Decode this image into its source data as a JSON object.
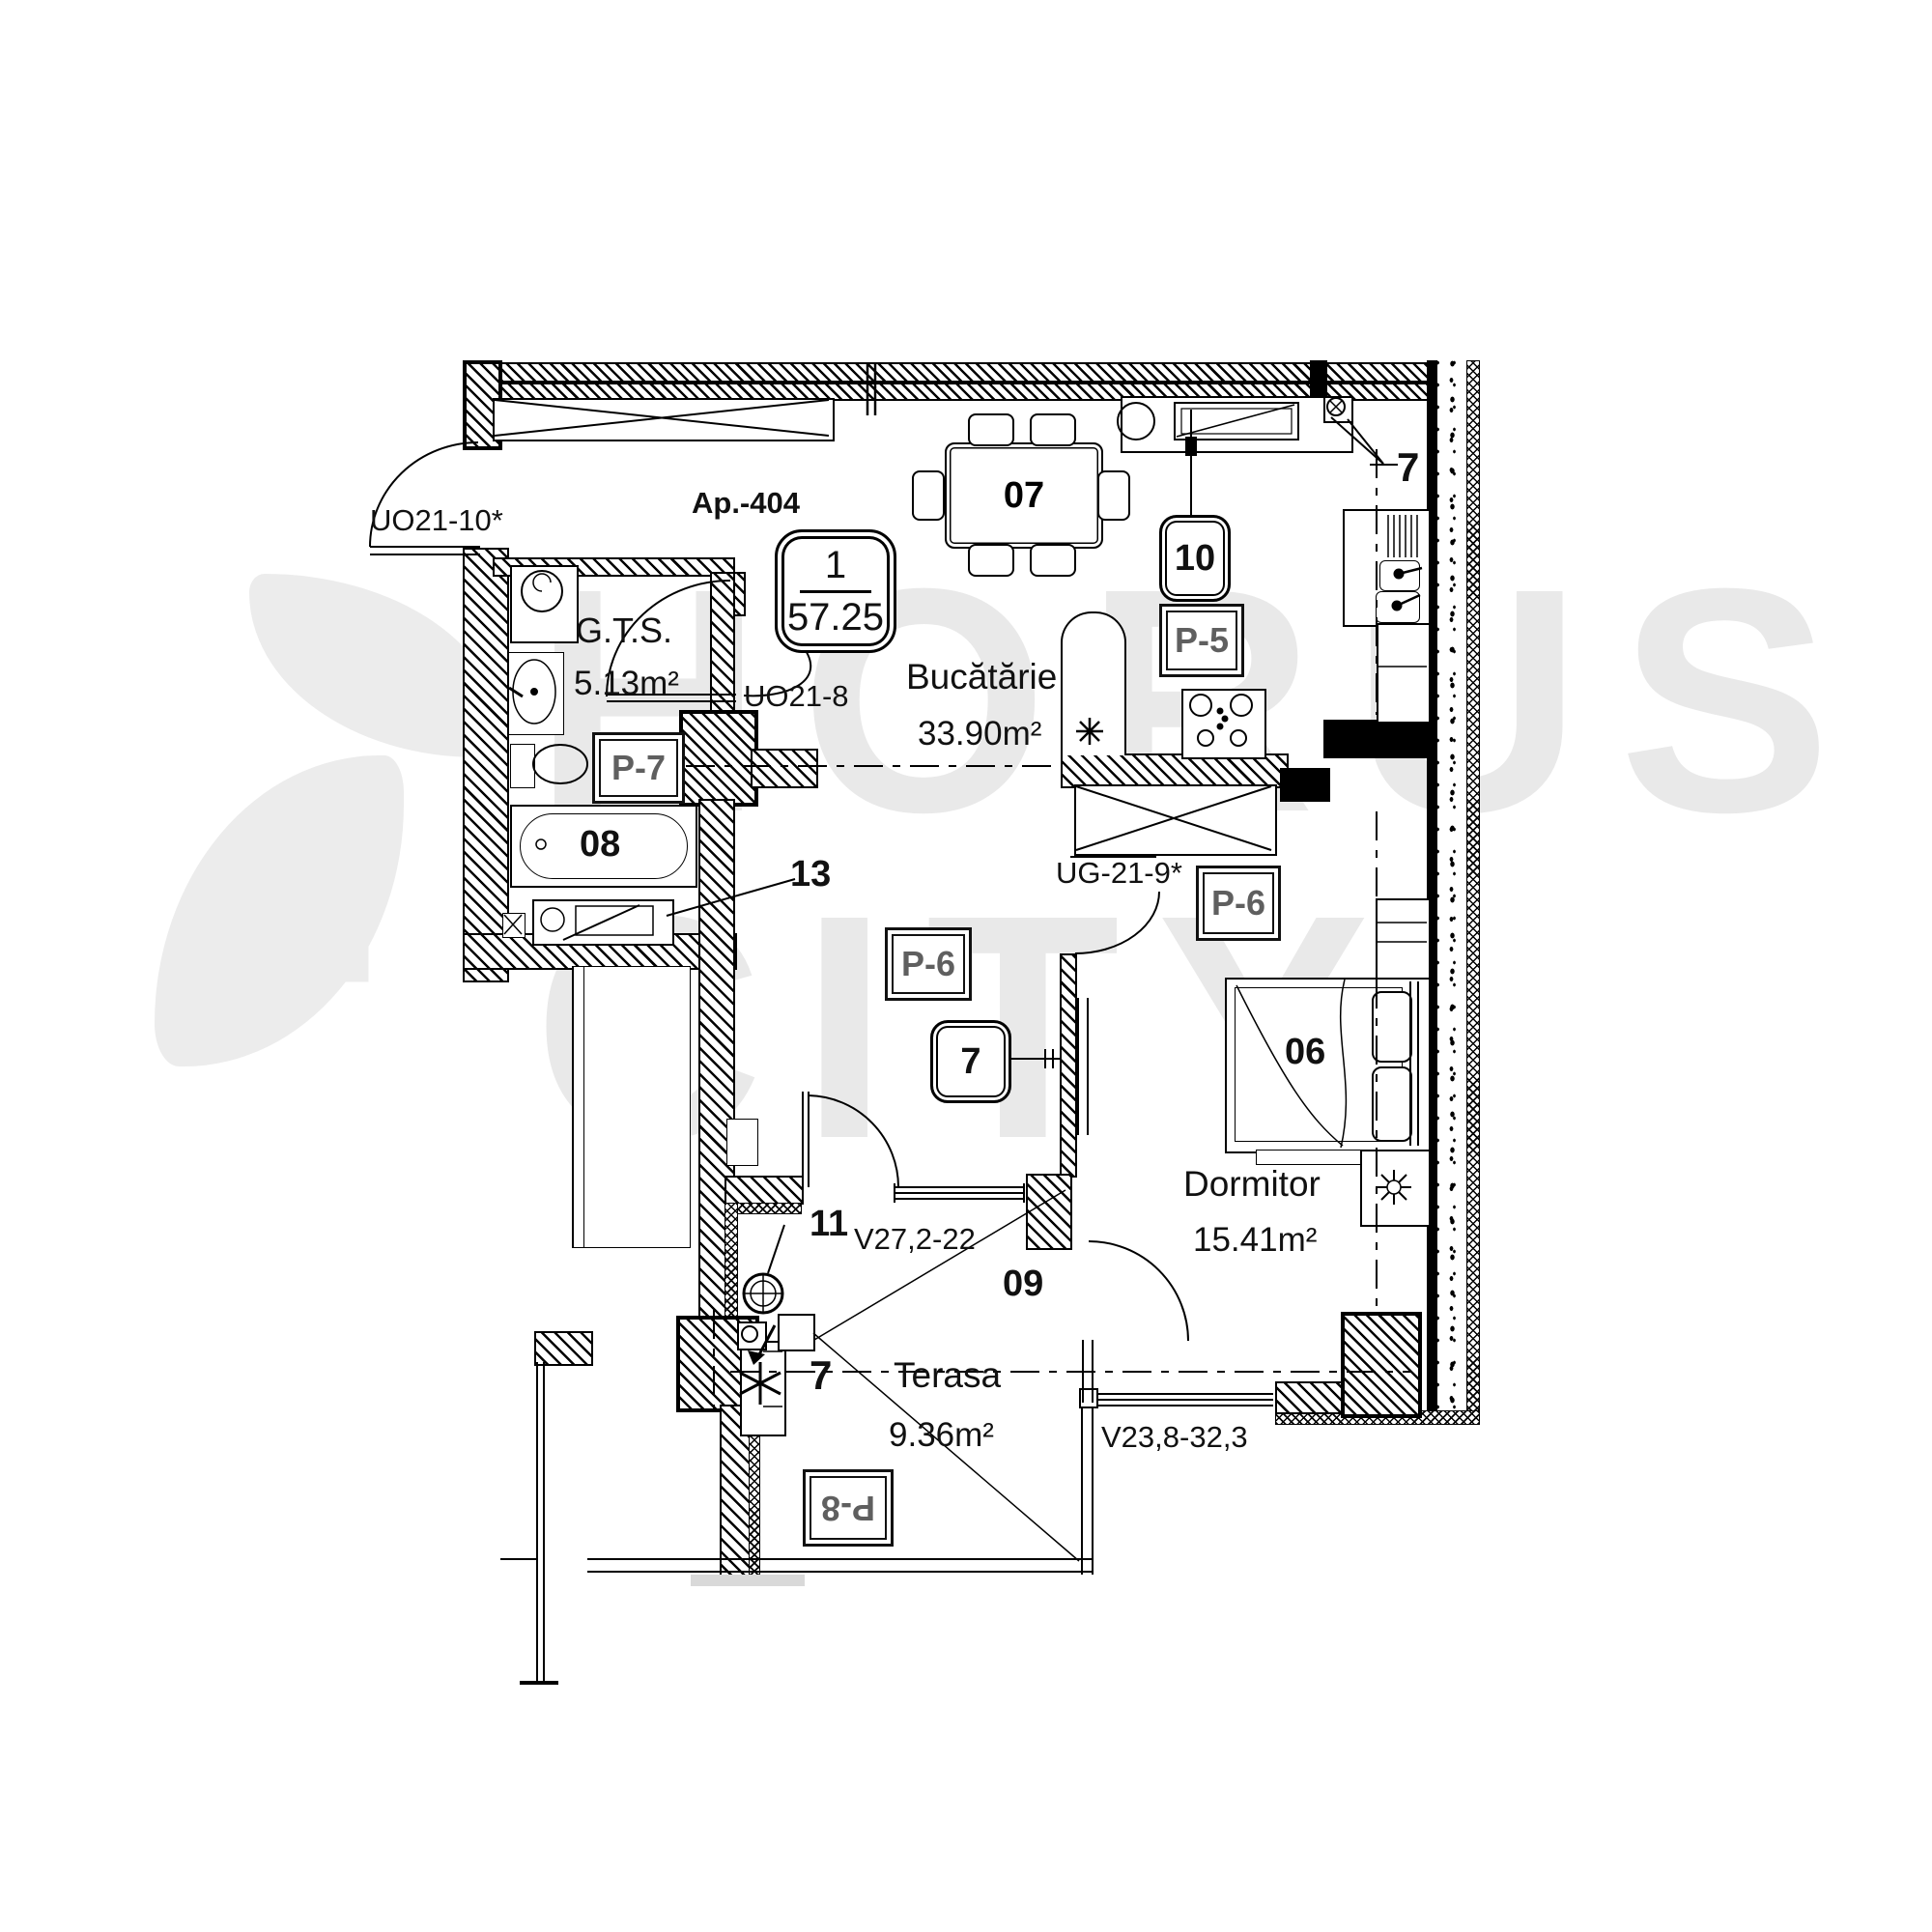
{
  "title": {
    "apartment": "Ap.-404"
  },
  "badge": {
    "rooms": "1",
    "area": "57.25"
  },
  "rooms": {
    "bathroom": {
      "name": "G.T.S.",
      "area": "5.13m²"
    },
    "kitchen": {
      "name": "Bucătărie",
      "area": "33.90m²"
    },
    "bedroom": {
      "name": "Dormitor",
      "area": "15.41m²"
    },
    "terrace": {
      "name": "Terasa",
      "area": "9.36m²"
    }
  },
  "codes": {
    "entrance_door": "UO21-10*",
    "bathroom_door": "UO21-8",
    "bedroom_door": "UG-21-9*",
    "living_terrace_window": "V27,2-22",
    "bedroom_terrace_window": "V23,8-32,3"
  },
  "item_numbers": {
    "dining_table": "07",
    "bathtub": "08",
    "bed": "06",
    "terrace_door": "09",
    "kitchen_badge": "10",
    "living_badge": "7",
    "kitchen_window": "7",
    "terrace_ac": "7",
    "hall_item": "13",
    "terrace_item": "11"
  },
  "finish_labels": {
    "bathroom": "P-7",
    "kitchen": "P-5",
    "living": "P-6",
    "bedroom": "P-6",
    "terrace": "P-8"
  },
  "watermark": {
    "line1": "HORUS",
    "line2": "CITY"
  },
  "colors": {
    "line": "#000000",
    "finish_label": "#5f5f5f",
    "watermark": "#e9e9e9"
  }
}
